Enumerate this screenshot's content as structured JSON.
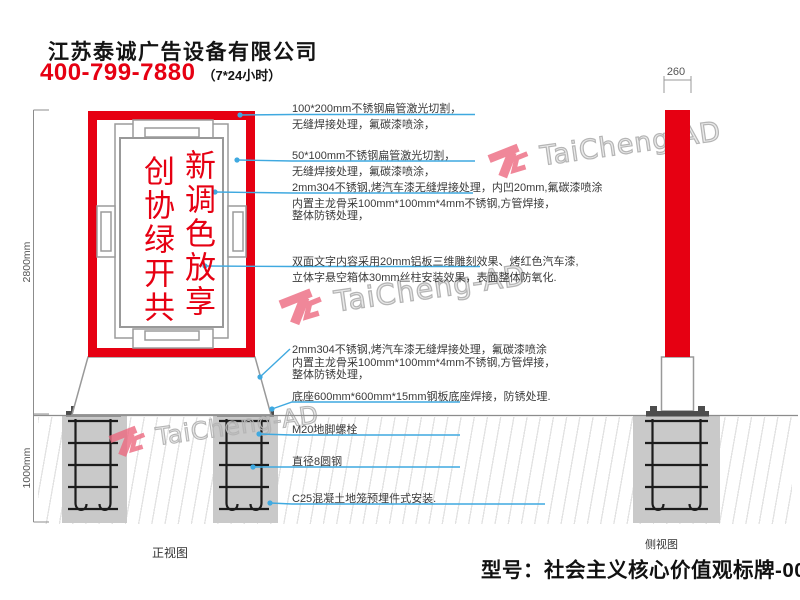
{
  "header": {
    "company": "江苏泰诚广告设备有限公司",
    "phone": "400-799-7880",
    "hours": "（7*24小时）"
  },
  "watermark": {
    "text": "TaiCheng-AD"
  },
  "sign": {
    "right_column": "新调色放享",
    "left_column": "创协绿开共"
  },
  "annotations": [
    {
      "lines": [
        "100*200mm不锈钢扁管激光切割，",
        "无缝焊接处理，氟碳漆喷涂，"
      ]
    },
    {
      "lines": [
        "50*100mm不锈钢扁管激光切割，",
        "无缝焊接处理，氟碳漆喷涂，"
      ]
    },
    {
      "lines": [
        "2mm304不锈钢,烤汽车漆无缝焊接处理，内凹20mm,氟碳漆喷涂",
        "内置主龙骨采100mm*100mm*4mm不锈钢,方管焊接，",
        "整体防锈处理，"
      ]
    },
    {
      "lines": [
        "双面文字内容采用20mm铝板三维雕刻效果、烤红色汽车漆,",
        "立体字悬空箱体30mm丝柱安装效果，表面整体防氧化."
      ]
    },
    {
      "lines": [
        "2mm304不锈钢,烤汽车漆无缝焊接处理，氟碳漆喷涂",
        "内置主龙骨采100mm*100mm*4mm不锈钢,方管焊接，",
        "整体防锈处理，"
      ]
    },
    {
      "lines": [
        "底座600mm*600mm*15mm钢板底座焊接，防锈处理."
      ]
    },
    {
      "lines": [
        "M20地脚螺栓"
      ]
    },
    {
      "lines": [
        "直径8圆钢"
      ]
    },
    {
      "lines": [
        "C25混凝土地笼预埋件式安装."
      ]
    }
  ],
  "dimensions": {
    "height_above_ground": "2800mm",
    "foundation_depth": "1000mm",
    "side_width": "260"
  },
  "view_labels": {
    "front": "正视图",
    "side": "侧视图"
  },
  "footer": {
    "model_label": "型号：社会主义核心价值观标牌-0076"
  },
  "colors": {
    "red": "#e60012",
    "leader_blue": "#3fa9e0",
    "concrete": "#c9c9c9",
    "lattice_gray": "#9b9b9b",
    "watermark_pink": "#ed6a80"
  }
}
